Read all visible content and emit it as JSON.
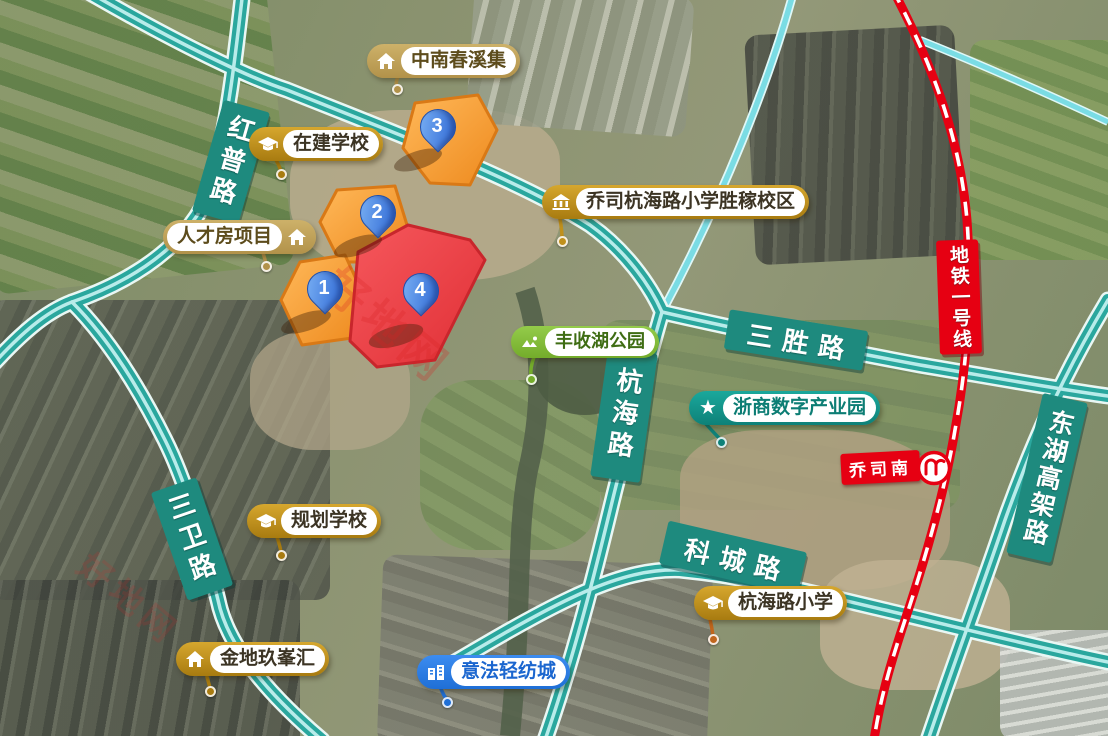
{
  "watermark": {
    "text": "好地网"
  },
  "roads": {
    "hongpu": "红普路",
    "sansheng": "三胜路",
    "hanghai": "杭海路",
    "kecheng": "科城路",
    "sanwei": "三卫路",
    "donghu": "东湖高架路"
  },
  "metro": {
    "line_label": "地铁一号线",
    "station": "乔司南",
    "line_color": "#e60012"
  },
  "plots": [
    {
      "number": "1",
      "color": "orange"
    },
    {
      "number": "2",
      "color": "orange"
    },
    {
      "number": "3",
      "color": "orange"
    },
    {
      "number": "4",
      "color": "red"
    }
  ],
  "pois": [
    {
      "label": "中南春溪集",
      "icon": "house-icon",
      "theme": "tan"
    },
    {
      "label": "在建学校",
      "icon": "graduation-cap-icon",
      "theme": "gold"
    },
    {
      "label": "人才房项目",
      "icon": "house-icon",
      "theme": "tan"
    },
    {
      "label": "乔司杭海路小学胜稼校区",
      "icon": "school-icon",
      "theme": "gold"
    },
    {
      "label": "丰收湖公园",
      "icon": "park-icon",
      "theme": "green"
    },
    {
      "label": "浙商数字产业园",
      "icon": "star-icon",
      "theme": "teal"
    },
    {
      "label": "规划学校",
      "icon": "graduation-cap-icon",
      "theme": "gold"
    },
    {
      "label": "金地玖峯汇",
      "icon": "house-icon",
      "theme": "gold"
    },
    {
      "label": "杭海路小学",
      "icon": "graduation-cap-icon",
      "theme": "gold"
    },
    {
      "label": "意法轻纺城",
      "icon": "building-icon",
      "theme": "blue"
    }
  ],
  "colors": {
    "road_highlight": "#2aa79e",
    "road_plate": "#1e8a7e",
    "plot_orange": "#f9a13a",
    "plot_red": "#ef4146",
    "pin_blue": "#2a63d2"
  }
}
